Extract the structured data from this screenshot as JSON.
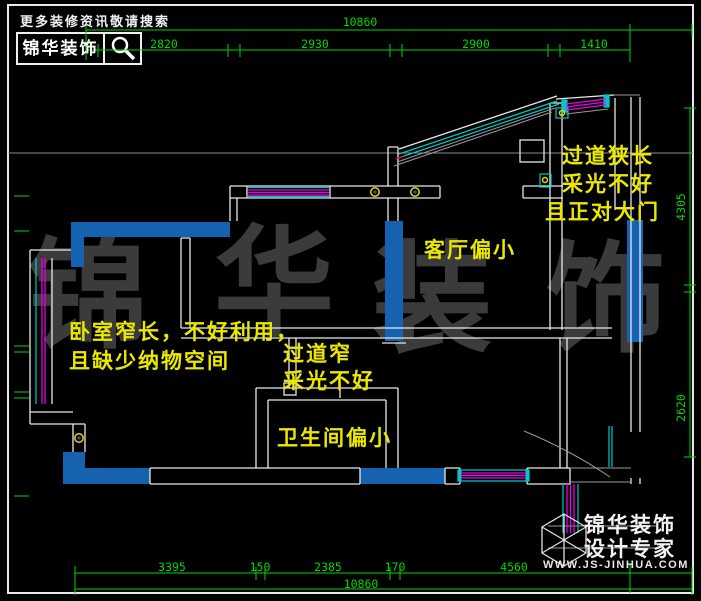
{
  "header": {
    "tagline": "更多装修资讯敬请搜索",
    "brand": "锦华装饰",
    "search_icon": "magnifier"
  },
  "watermark": {
    "chars": [
      "锦",
      "华",
      "装",
      "饰"
    ]
  },
  "annotations": {
    "entry": [
      "过道狭长",
      "采光不好",
      "且正对大门"
    ],
    "living_room": "客厅偏小",
    "bedroom": [
      "卧室窄长，不好利用，",
      "且缺少纳物空间"
    ],
    "corridor": [
      "过道窄",
      "采光不好"
    ],
    "bathroom": "卫生间偏小"
  },
  "dimensions": {
    "top": {
      "total": "10860",
      "segments": [
        "2820",
        "2930",
        "2900",
        "1410"
      ]
    },
    "bottom": {
      "total": "10860",
      "segments": [
        "3395",
        "150",
        "2385",
        "170",
        "4560"
      ]
    },
    "right": {
      "segments": [
        "4305",
        "2620"
      ]
    }
  },
  "footer_logo": {
    "brand": "锦华装饰",
    "tagline": "设计专家",
    "website": "WWW.JS-JINHUA.COM",
    "cube_icon": "isometric-cube"
  },
  "colors": {
    "background": "#000000",
    "dimension_green": "#00d800",
    "annotation_yellow": "#ebe800",
    "wall_white": "#e8e8e8",
    "wall_fill_blue": "#1563b0",
    "window_magenta": "#e800e8",
    "window_cyan": "#00c8c8",
    "watermark_gray": "#3b3b3b"
  }
}
